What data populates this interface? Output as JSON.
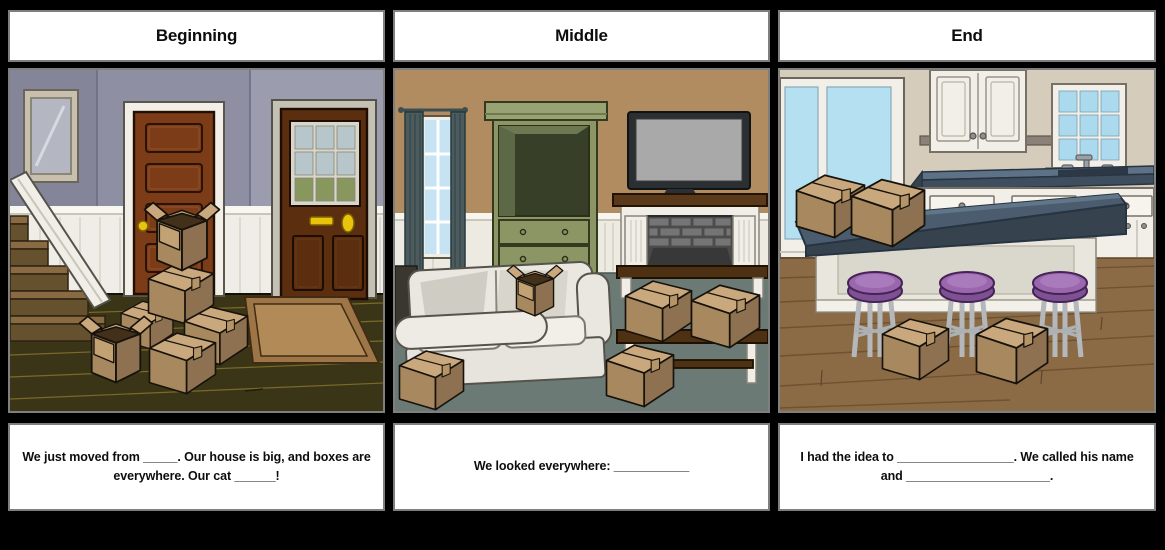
{
  "storyboard": {
    "columns": [
      {
        "id": "beginning",
        "title": "Beginning",
        "caption": "We just moved from _____. Our house is big, and boxes are everywhere. Our cat ______!",
        "scene": "entryway-hallway-with-moving-boxes"
      },
      {
        "id": "middle",
        "title": "Middle",
        "caption": "We looked everywhere: ___________",
        "scene": "living-room-with-moving-boxes"
      },
      {
        "id": "end",
        "title": "End",
        "caption": "I had the idea to _________________. We called his name and _____________________.",
        "scene": "kitchen-island-with-moving-boxes"
      }
    ],
    "colors": {
      "page_background": "#000000",
      "cell_border": "#7f7f7f",
      "cell_background": "#ffffff",
      "cardboard_front": "#a8895f",
      "cardboard_top": "#c9a87d",
      "cardboard_side": "#8d7150",
      "hall_wall": "#8f8fa3",
      "living_wall": "#b08c60",
      "kitchen_wall": "#d5ccbc",
      "island_counter": "#4a5c6e",
      "stool_purple": "#9a67ac",
      "wood_floor_dark": "#3b3517",
      "wood_floor_kitchen": "#8b6b45",
      "living_floor": "#6b7a74"
    }
  }
}
